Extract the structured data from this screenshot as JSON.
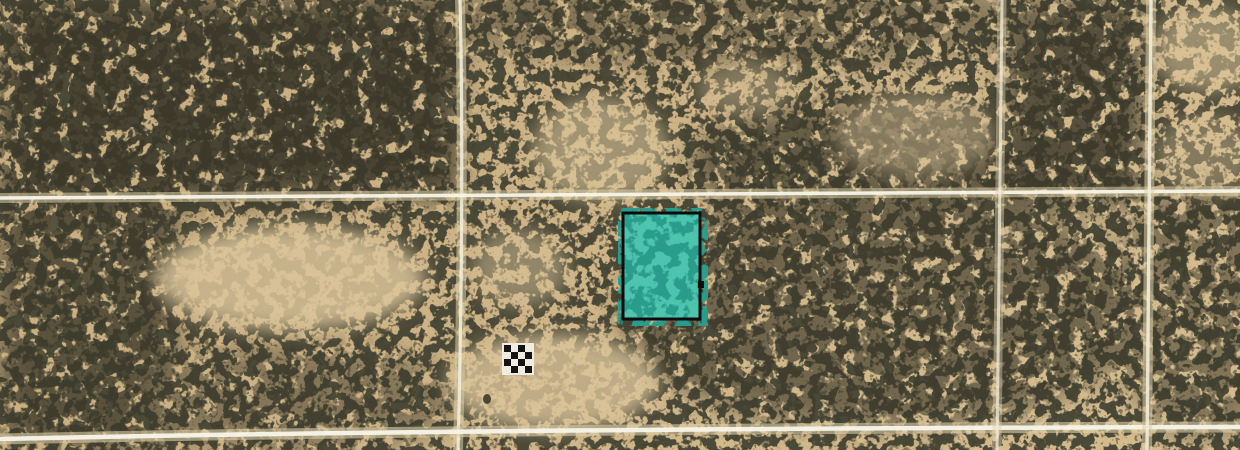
{
  "scene": {
    "kind": "satellite-aerial-imagery",
    "features": [
      "desert-scrubland",
      "dirt-road-grid",
      "highlighted-parcel",
      "survey-checkerboard-marker"
    ]
  },
  "colors": {
    "sand_base": "#c9ae80",
    "sand_light": "#d6bd90",
    "sand_clearing": "#dcc69b",
    "vegetation": "#4c4a38",
    "vegetation_fine": "#45432f",
    "vegetation_dense": "#3a392a",
    "road_halo": "#dccda6",
    "road_core": "#f1ecd9",
    "road_core_bright": "#f8f5ea",
    "parcel_fill": "#4ec4ae",
    "parcel_mottle": "#2a9c8c",
    "parcel_border": "#0d0d0d",
    "marker_black": "#141414",
    "marker_white": "#f0ece1",
    "object_dark": "#33321f"
  },
  "parcel": {
    "x": 623,
    "y": 213,
    "width": 77,
    "height": 106,
    "border_width": 3,
    "notch": {
      "x": 698,
      "y": 281,
      "width": 6,
      "height": 7
    }
  },
  "marker": {
    "bg": {
      "x": 502,
      "y": 343,
      "width": 32,
      "height": 32
    },
    "x": 503,
    "y": 344,
    "cell": 7,
    "pad": 1,
    "pattern": [
      "bwbw",
      "wbwb",
      "bwbw",
      "wbwb"
    ]
  },
  "roads": {
    "vertical_west": {
      "d": "M460,0 C463,120 462,300 458,450"
    },
    "horizontal_mid": {
      "d": "M0,198 C400,196 800,193 1240,191"
    },
    "horizontal_bottom": {
      "d": "M0,439 C350,431 800,428 1240,427"
    },
    "vertical_east": {
      "d": "M1002,0 C1000,150 999,300 997,450"
    },
    "vertical_far_east": {
      "d": "M1151,0 C1149,150 1148,300 1147,450"
    }
  },
  "small_object": {
    "cx": 487,
    "cy": 399,
    "rx": 4,
    "ry": 5
  }
}
